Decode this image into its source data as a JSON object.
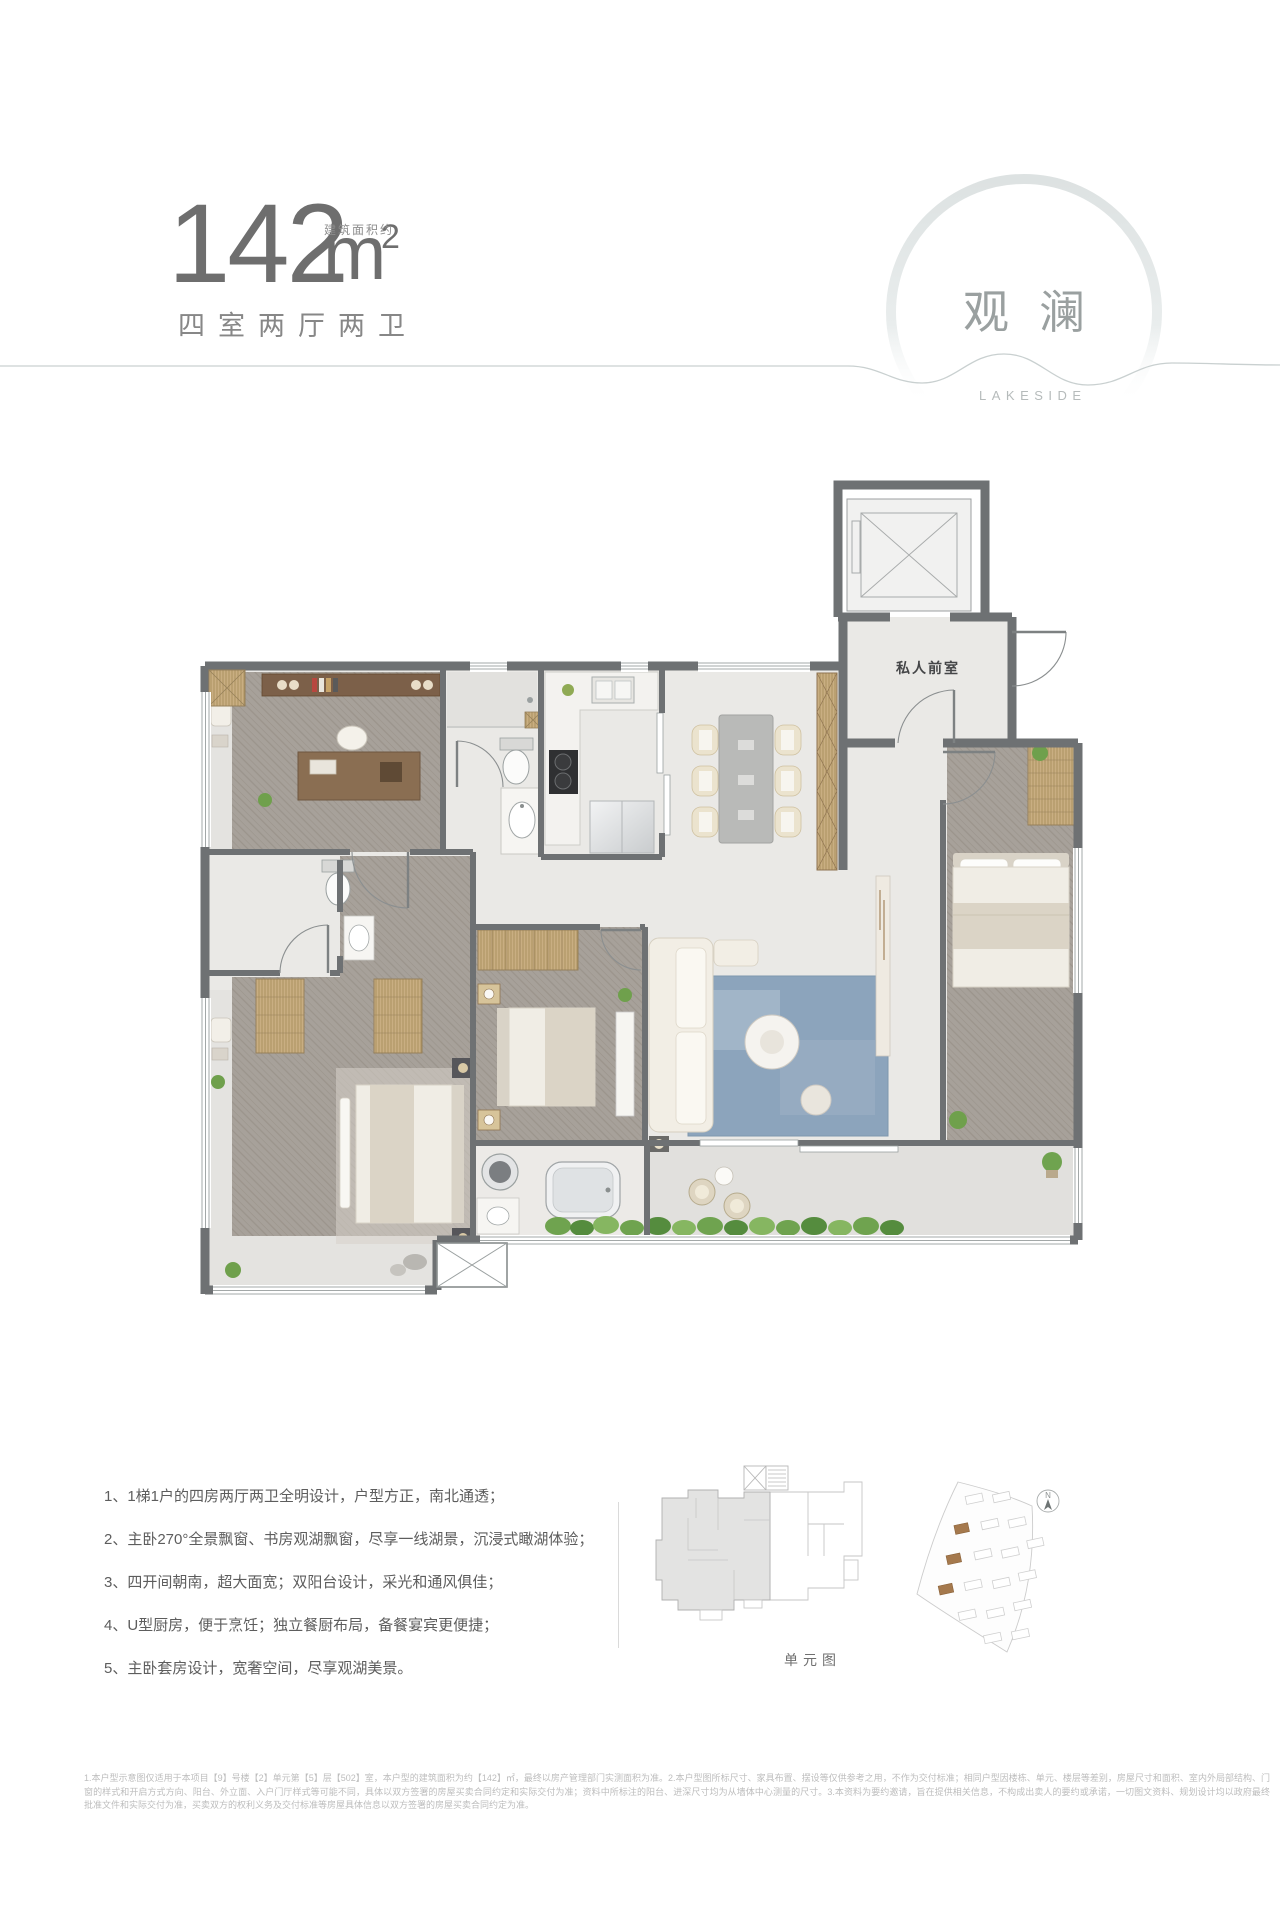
{
  "header": {
    "area_value": "142",
    "area_unit": "m",
    "area_sup": "2",
    "area_note": "建筑面积约",
    "layout_label": "四室两厅两卫"
  },
  "emblem": {
    "title_cn": "观澜",
    "title_en": "LAKESIDE"
  },
  "floor_plan": {
    "foyer_label": "私人前室"
  },
  "features": {
    "items": [
      "1、1梯1户的四房两厅两卫全明设计，户型方正，南北通透；",
      "2、主卧270°全景飘窗、书房观湖飘窗，尽享一线湖景，沉浸式瞰湖体验；",
      "3、四开间朝南，超大面宽；双阳台设计，采光和通风俱佳；",
      "4、U型厨房，便于烹饪；独立餐厨布局，备餐宴宾更便捷；",
      "5、主卧套房设计，宽奢空间，尽享观湖美景。"
    ]
  },
  "unit_diagram": {
    "caption": "单元图"
  },
  "site_plan": {
    "compass_label": "N"
  },
  "disclaimer": {
    "text": "1.本户型示意图仅适用于本项目【9】号楼【2】单元第【5】层【502】室，本户型的建筑面积为约【142】㎡，最终以房产管理部门实测面积为准。2.本户型图所标尺寸、家具布置、摆设等仅供参考之用，不作为交付标准；相同户型因楼栋、单元、楼层等差别，房屋尺寸和面积、室内外局部结构、门窗的样式和开启方式方向、阳台、外立面、入户门厅样式等可能不同，具体以双方签署的房屋买卖合同约定和实际交付为准；资料中所标注的阳台、进深尺寸均为从墙体中心测量的尺寸。3.本资料为要约邀请，旨在提供相关信息，不构成出卖人的要约或承诺，一切图文资料、规划设计均以政府最终批准文件和实际交付为准，买卖双方的权利义务及交付标准等房屋具体信息以双方签署的房屋买卖合同约定为准。"
  },
  "colors": {
    "wall": "#6e7173",
    "wood": "#a7a19a",
    "marble": "#eae9e6",
    "rug_blue": "#8ca4bc",
    "wardrobe_tan": "#c9ae82",
    "site_highlight": "#a5794d"
  }
}
